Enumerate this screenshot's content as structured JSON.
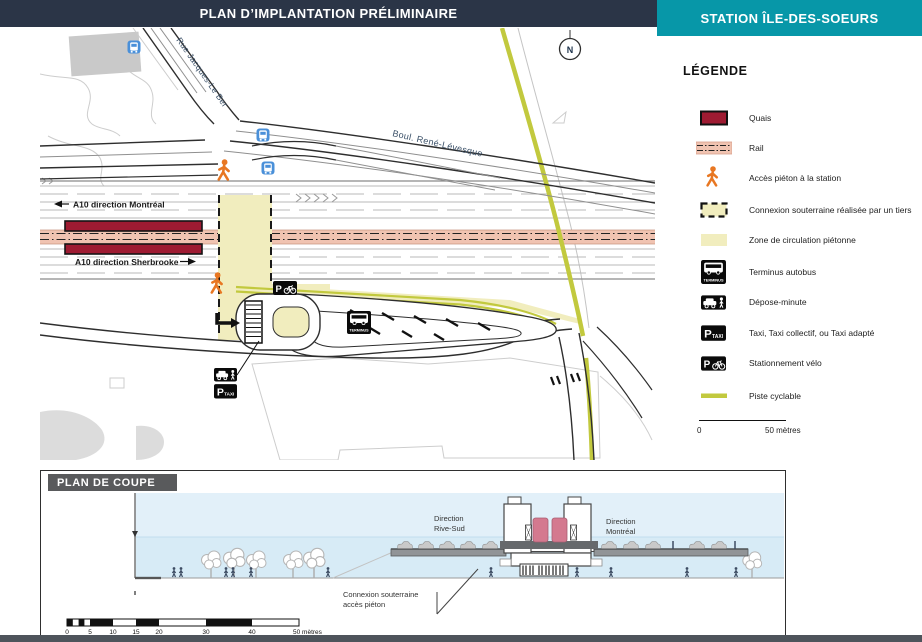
{
  "header": {
    "title": "PLAN D’IMPLANTATION PRÉLIMINAIRE",
    "station": "STATION ÎLE-DES-SOEURS"
  },
  "map": {
    "north_label": "N",
    "streets": {
      "jacques_le_ber": "Rue Jacques-Le Ber",
      "rene_levesque": "Boul. René-Lévesque"
    },
    "highway": {
      "montreal": "A10 direction Montréal",
      "sherbrooke": "A10 direction Sherbrooke"
    },
    "signs": {
      "terminus": "TERMINUS",
      "p": "P",
      "taxi": "TAXI"
    }
  },
  "legend": {
    "title": "LÉGENDE",
    "items": [
      {
        "id": "quais",
        "label": "Quais"
      },
      {
        "id": "rail",
        "label": "Rail"
      },
      {
        "id": "acces-pieton",
        "label": "Accès piéton à la station"
      },
      {
        "id": "connexion-souterraine",
        "label": "Connexion souterraine réalisée par un tiers"
      },
      {
        "id": "zone-pietonne",
        "label": "Zone de circulation piétonne"
      },
      {
        "id": "terminus-autobus",
        "label": "Terminus autobus"
      },
      {
        "id": "depose-minute",
        "label": "Dépose-minute"
      },
      {
        "id": "taxi",
        "label": "Taxi, Taxi collectif, ou Taxi adapté"
      },
      {
        "id": "stationnement-velo",
        "label": "Stationnement vélo"
      },
      {
        "id": "piste-cyclable",
        "label": "Piste cyclable"
      }
    ],
    "scale": {
      "start": "0",
      "end": "50 mètres"
    }
  },
  "coupe": {
    "title": "PLAN DE COUPE",
    "direction_rive_sud_line1": "Direction",
    "direction_rive_sud_line2": "Rive-Sud",
    "direction_montreal_line1": "Direction",
    "direction_montreal_line2": "Montréal",
    "connexion_line1": "Connexion souterraine",
    "connexion_line2": "accès piéton",
    "scale_ticks": [
      "0",
      "5",
      "10",
      "15",
      "20",
      "30",
      "40",
      "50 mètres"
    ]
  },
  "colors": {
    "header_navy": "#2B3547",
    "header_teal": "#0797A8",
    "quais_red": "#9E1B32",
    "rail_salmon": "#F0C3B1",
    "pedestrian_zone_yellow": "#F1EDBE",
    "bike_path_olive": "#C2C93E",
    "pedestrian_access_orange": "#E87722",
    "bus_stop_blue": "#4A90D9",
    "sky_blue": "#DCEEF8",
    "bottom_bar": "#4E545B"
  }
}
